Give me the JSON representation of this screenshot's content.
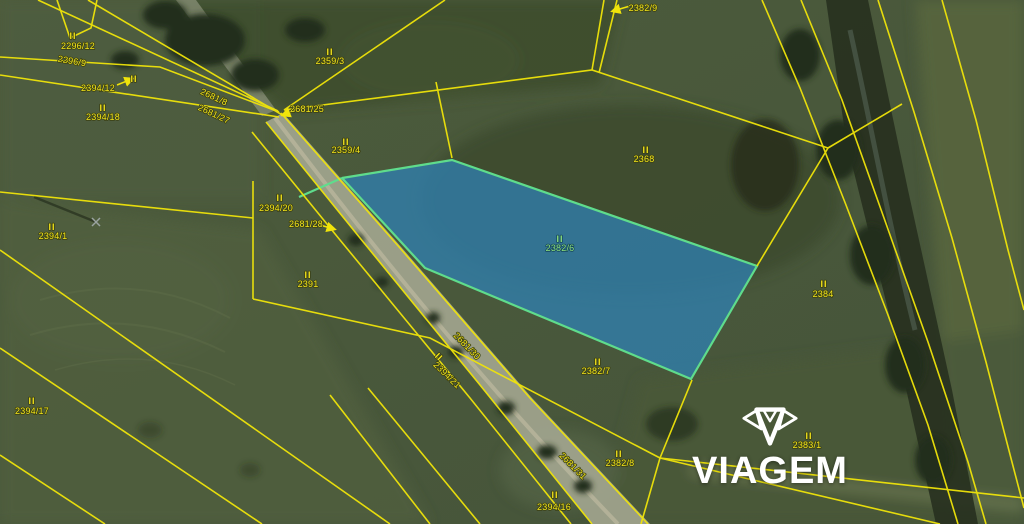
{
  "branding": {
    "logo_text": "VIAGEM"
  },
  "map": {
    "line_color": "#f0e40a",
    "label_color": "#f2e41c",
    "highlight_label_color": "#8ee27e",
    "highlighted_parcel": {
      "number": "2382/6",
      "fill": "#2f7fae",
      "fill_opacity": 0.78,
      "stroke": "#5fdc8c",
      "points": [
        [
          342,
          178
        ],
        [
          452,
          160
        ],
        [
          757,
          266
        ],
        [
          691,
          379
        ],
        [
          425,
          268
        ]
      ],
      "extension": [
        [
          299,
          197
        ],
        [
          342,
          178
        ]
      ]
    },
    "boundary_lines": [
      [
        [
          38,
          0
        ],
        [
          278,
          111
        ]
      ],
      [
        [
          88,
          0
        ],
        [
          284,
          116
        ]
      ],
      [
        [
          0,
          57
        ],
        [
          160,
          67
        ],
        [
          279,
          112
        ]
      ],
      [
        [
          0,
          75
        ],
        [
          279,
          117
        ]
      ],
      [
        [
          57,
          0
        ],
        [
          70,
          38
        ],
        [
          91,
          28
        ],
        [
          97,
          0
        ]
      ],
      [
        [
          252,
          132
        ],
        [
          340,
          240
        ],
        [
          470,
          398
        ],
        [
          571,
          524
        ]
      ],
      [
        [
          266,
          122
        ],
        [
          360,
          238
        ],
        [
          480,
          385
        ],
        [
          592,
          524
        ]
      ],
      [
        [
          281,
          113
        ],
        [
          400,
          248
        ],
        [
          530,
          398
        ],
        [
          648,
          524
        ]
      ],
      [
        [
          284,
          110
        ],
        [
          445,
          0
        ]
      ],
      [
        [
          284,
          110
        ],
        [
          592,
          70
        ],
        [
          828,
          148
        ]
      ],
      [
        [
          592,
          70
        ],
        [
          604,
          0
        ]
      ],
      [
        [
          599,
          73
        ],
        [
          617,
          0
        ]
      ],
      [
        [
          828,
          148
        ],
        [
          902,
          104
        ]
      ],
      [
        [
          757,
          266
        ],
        [
          828,
          148
        ]
      ],
      [
        [
          253,
          181
        ],
        [
          253,
          299
        ]
      ],
      [
        [
          0,
          192
        ],
        [
          253,
          218
        ]
      ],
      [
        [
          253,
          299
        ],
        [
          430,
          338
        ],
        [
          660,
          458
        ]
      ],
      [
        [
          0,
          250
        ],
        [
          390,
          524
        ]
      ],
      [
        [
          0,
          348
        ],
        [
          262,
          524
        ]
      ],
      [
        [
          0,
          455
        ],
        [
          105,
          524
        ]
      ],
      [
        [
          762,
          0
        ],
        [
          800,
          88
        ],
        [
          846,
          205
        ],
        [
          888,
          315
        ],
        [
          928,
          425
        ],
        [
          958,
          524
        ]
      ],
      [
        [
          801,
          0
        ],
        [
          842,
          100
        ],
        [
          884,
          218
        ],
        [
          928,
          342
        ],
        [
          968,
          462
        ],
        [
          986,
          524
        ]
      ],
      [
        [
          878,
          0
        ],
        [
          914,
          112
        ],
        [
          952,
          238
        ],
        [
          986,
          362
        ],
        [
          1013,
          466
        ],
        [
          1024,
          508
        ]
      ],
      [
        [
          692,
          380
        ],
        [
          660,
          458
        ],
        [
          641,
          524
        ]
      ],
      [
        [
          660,
          458
        ],
        [
          940,
          524
        ]
      ],
      [
        [
          660,
          458
        ],
        [
          1024,
          498
        ]
      ],
      [
        [
          436,
          82
        ],
        [
          452,
          158
        ]
      ],
      [
        [
          368,
          388
        ],
        [
          480,
          524
        ]
      ],
      [
        [
          330,
          395
        ],
        [
          430,
          524
        ]
      ],
      [
        [
          942,
          0
        ],
        [
          976,
          120
        ],
        [
          1008,
          250
        ],
        [
          1024,
          310
        ]
      ]
    ],
    "labels": [
      {
        "text": "2296/12",
        "x": 78,
        "y": 46,
        "rot": 0,
        "marker": {
          "x": 73,
          "y": 36,
          "rot": 0
        }
      },
      {
        "text": "2296/9",
        "x": 72,
        "y": 61,
        "rot": 10,
        "marker": null
      },
      {
        "text": "2394/12",
        "x": 98,
        "y": 88,
        "rot": 0,
        "marker": {
          "x": 134,
          "y": 79,
          "rot": 0
        }
      },
      {
        "text": "2394/18",
        "x": 103,
        "y": 117,
        "rot": 0,
        "marker": {
          "x": 103,
          "y": 108,
          "rot": 0
        }
      },
      {
        "text": "2359/3",
        "x": 330,
        "y": 61,
        "rot": 0,
        "marker": {
          "x": 330,
          "y": 52,
          "rot": 0
        }
      },
      {
        "text": "2681/25",
        "x": 307,
        "y": 109,
        "rot": 0,
        "marker": null
      },
      {
        "text": "2359/4",
        "x": 346,
        "y": 150,
        "rot": 0,
        "marker": {
          "x": 346,
          "y": 142,
          "rot": 0
        }
      },
      {
        "text": "2382/9",
        "x": 643,
        "y": 8,
        "rot": 0,
        "marker": null
      },
      {
        "text": "2368",
        "x": 644,
        "y": 159,
        "rot": 0,
        "marker": {
          "x": 646,
          "y": 150,
          "rot": 0
        }
      },
      {
        "text": "2382/6",
        "x": 560,
        "y": 248,
        "rot": 0,
        "green": true,
        "marker": {
          "x": 560,
          "y": 239,
          "rot": 0
        }
      },
      {
        "text": "2394/1",
        "x": 53,
        "y": 236,
        "rot": 0,
        "marker": {
          "x": 52,
          "y": 227,
          "rot": 0
        }
      },
      {
        "text": "2394/20",
        "x": 276,
        "y": 208,
        "rot": 0,
        "marker": {
          "x": 280,
          "y": 198,
          "rot": 0
        }
      },
      {
        "text": "2681/28",
        "x": 306,
        "y": 224,
        "rot": 0,
        "marker": null
      },
      {
        "text": "2391",
        "x": 308,
        "y": 284,
        "rot": 0,
        "marker": {
          "x": 308,
          "y": 275,
          "rot": 0
        }
      },
      {
        "text": "2394/17",
        "x": 32,
        "y": 411,
        "rot": 0,
        "marker": {
          "x": 32,
          "y": 401,
          "rot": 0
        }
      },
      {
        "text": "2681/30",
        "x": 467,
        "y": 346,
        "rot": 46,
        "marker": null
      },
      {
        "text": "2394/21",
        "x": 447,
        "y": 375,
        "rot": 44,
        "marker": {
          "x": 439,
          "y": 357,
          "rot": 44
        }
      },
      {
        "text": "2382/7",
        "x": 596,
        "y": 371,
        "rot": 0,
        "marker": {
          "x": 598,
          "y": 362,
          "rot": 0
        }
      },
      {
        "text": "2384",
        "x": 823,
        "y": 294,
        "rot": 0,
        "marker": {
          "x": 824,
          "y": 284,
          "rot": 0
        }
      },
      {
        "text": "2382/8",
        "x": 620,
        "y": 463,
        "rot": 0,
        "marker": {
          "x": 619,
          "y": 454,
          "rot": 0
        }
      },
      {
        "text": "2383/1",
        "x": 807,
        "y": 445,
        "rot": 0,
        "marker": {
          "x": 809,
          "y": 436,
          "rot": 0
        }
      },
      {
        "text": "2394/16",
        "x": 554,
        "y": 507,
        "rot": 0,
        "marker": {
          "x": 555,
          "y": 495,
          "rot": 0
        }
      },
      {
        "text": "2681/8",
        "x": 214,
        "y": 97,
        "rot": 25,
        "marker": null
      },
      {
        "text": "2681/27",
        "x": 214,
        "y": 114,
        "rot": 25,
        "marker": null
      },
      {
        "text": "2681/31",
        "x": 573,
        "y": 466,
        "rot": 45,
        "marker": null
      }
    ],
    "arrows": [
      {
        "x1": 630,
        "y1": 6,
        "x2": 613,
        "y2": 11
      },
      {
        "x1": 296,
        "y1": 110,
        "x2": 283,
        "y2": 115
      },
      {
        "x1": 320,
        "y1": 225,
        "x2": 334,
        "y2": 229
      },
      {
        "x1": 117,
        "y1": 85,
        "x2": 132,
        "y2": 79
      }
    ]
  }
}
